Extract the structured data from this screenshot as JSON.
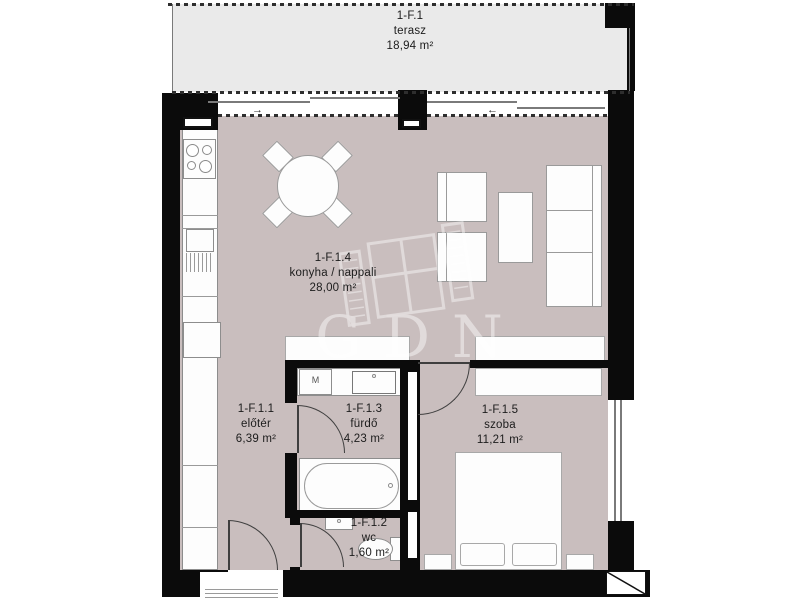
{
  "plan": {
    "watermark_text": "GDN",
    "rooms": [
      {
        "code": "1-F.1",
        "name": "terasz",
        "area": "18,94 m²"
      },
      {
        "code": "1-F.1.4",
        "name": "konyha / nappali",
        "area": "28,00 m²"
      },
      {
        "code": "1-F.1.1",
        "name": "előtér",
        "area": "6,39 m²"
      },
      {
        "code": "1-F.1.3",
        "name": "fürdő",
        "area": "4,23 m²"
      },
      {
        "code": "1-F.1.2",
        "name": "wc",
        "area": "1,60 m²"
      },
      {
        "code": "1-F.1.5",
        "name": "szoba",
        "area": "11,21 m²"
      }
    ],
    "fixtures": {
      "washing_machine_label": "M"
    },
    "symbols": {
      "slide_arrow_right": "→",
      "slide_arrow_left": "←"
    },
    "colors": {
      "floor": "#c9bebe",
      "terrace": "#eaeaea",
      "wall": "#0b0b0b"
    }
  }
}
